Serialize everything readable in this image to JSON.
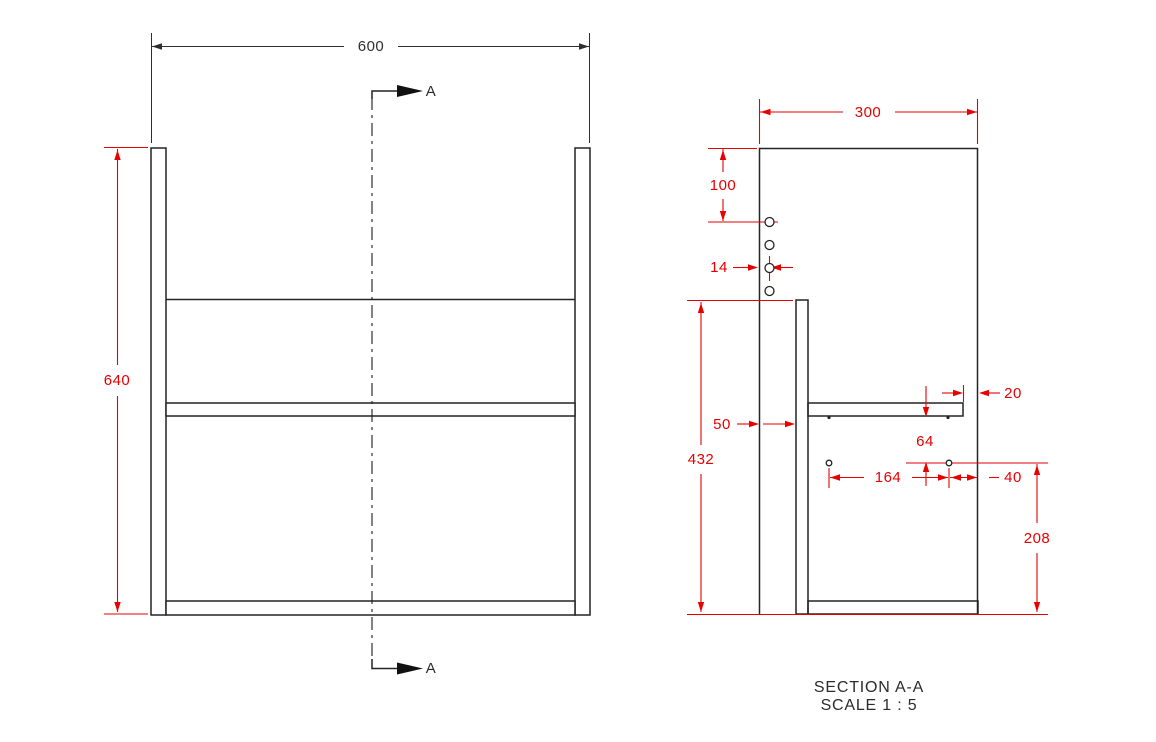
{
  "front_view": {
    "width_dim": "600",
    "height_dim": "640",
    "section_arrow_top": "A",
    "section_arrow_bottom": "A"
  },
  "section_view": {
    "depth_dim": "300",
    "top_to_first_hole_dim": "100",
    "hole_edge_offset_dim": "14",
    "front_gap_dim": "50",
    "back_panel_height_dim": "432",
    "shelf_setback_dim": "20",
    "shelf_to_hole_dim": "64",
    "hole_spacing_dim": "164",
    "hole_to_back_dim": "40",
    "hole_height_dim": "208",
    "caption_title": "SECTION A-A",
    "caption_scale": "SCALE 1 : 5"
  },
  "colors": {
    "dimension_red": "#e60000",
    "drawing_black": "#242424",
    "background": "#ffffff"
  }
}
